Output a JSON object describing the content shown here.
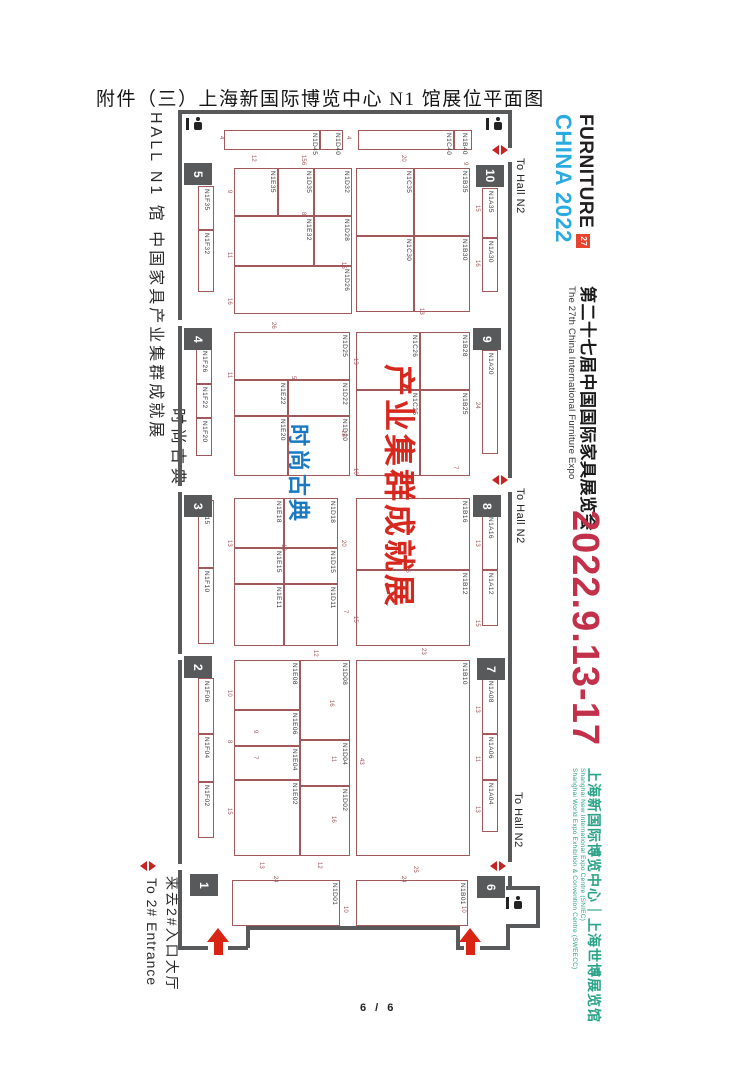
{
  "page": {
    "title": "附件（三）上海新国际博览中心 N1 馆展位平面图",
    "footer": "6 / 6"
  },
  "left_sidebar": {
    "hall_line": "HALL N1 馆  中国家具产业集群成就展",
    "hall_line2": "时尚古典",
    "entrance_en": "To 2# Entrance",
    "entrance_cn": "来去2#入口大厅"
  },
  "right_sidebar": {
    "logo": {
      "line1": "FURNITURE",
      "line2": "CHINA 2022",
      "badge": "27"
    },
    "expo_title_cn": "第二十七届中国国际家具展览会",
    "expo_title_en": "The 27th China International Furniture Expo",
    "dates": "2022.9.13-17",
    "venue_cn": "上海新国际博览中心｜上海世博展览馆",
    "venue_en1": "Shanghai New International Expo Centre (SNIEC)",
    "venue_en2": "Shanghai World Expo Exhibition & Convention Centre (SWEECC)",
    "colors": {
      "dates": "#c2304a",
      "venue": "#2aa389",
      "logo_blue": "#29abe2",
      "badge_bg": "#e8432f"
    }
  },
  "floorplan": {
    "overlay_red": "产业集群成就展",
    "overlay_blue": "时尚古典",
    "to_hall": {
      "label": "To Hall N2",
      "positions": [
        {
          "x": 514,
          "y": 158
        },
        {
          "x": 514,
          "y": 488
        },
        {
          "x": 512,
          "y": 792
        }
      ]
    },
    "gates": [
      {
        "n": "5",
        "x": 184,
        "y": 163
      },
      {
        "n": "4",
        "x": 184,
        "y": 328
      },
      {
        "n": "3",
        "x": 184,
        "y": 495
      },
      {
        "n": "2",
        "x": 184,
        "y": 656
      },
      {
        "n": "1",
        "x": 190,
        "y": 874
      },
      {
        "n": "10",
        "x": 476,
        "y": 165
      },
      {
        "n": "9",
        "x": 473,
        "y": 328
      },
      {
        "n": "8",
        "x": 473,
        "y": 495
      },
      {
        "n": "7",
        "x": 477,
        "y": 658
      },
      {
        "n": "6",
        "x": 477,
        "y": 876
      }
    ],
    "icons": {
      "gate_markers": [
        {
          "x": 492,
          "y": 145
        },
        {
          "x": 492,
          "y": 475
        },
        {
          "x": 490,
          "y": 861
        },
        {
          "x": 140,
          "y": 861
        }
      ],
      "entrance_arrows": [
        {
          "x": 206,
          "y": 928
        },
        {
          "x": 458,
          "y": 928
        }
      ],
      "restrooms": [
        {
          "x": 186,
          "y": 117
        },
        {
          "x": 486,
          "y": 117
        },
        {
          "x": 506,
          "y": 896
        }
      ]
    },
    "booths": [
      {
        "id": "N1D45",
        "x": 224,
        "y": 130,
        "w": 96,
        "h": 20
      },
      {
        "id": "N1D40",
        "x": 320,
        "y": 130,
        "w": 23,
        "h": 20
      },
      {
        "id": "N1C40",
        "x": 358,
        "y": 130,
        "w": 96,
        "h": 20
      },
      {
        "id": "N1B40",
        "x": 454,
        "y": 130,
        "w": 18,
        "h": 20
      },
      {
        "id": "N1F35",
        "x": 198,
        "y": 186,
        "w": 16,
        "h": 44
      },
      {
        "id": "N1F32",
        "x": 198,
        "y": 230,
        "w": 16,
        "h": 62
      },
      {
        "id": "N1E35",
        "x": 234,
        "y": 168,
        "w": 44,
        "h": 48
      },
      {
        "id": "N1D35",
        "x": 278,
        "y": 168,
        "w": 36,
        "h": 48
      },
      {
        "id": "N1D32",
        "x": 314,
        "y": 168,
        "w": 38,
        "h": 48
      },
      {
        "id": "N1E32",
        "x": 234,
        "y": 216,
        "w": 80,
        "h": 50
      },
      {
        "id": "N1D28",
        "x": 314,
        "y": 216,
        "w": 38,
        "h": 50
      },
      {
        "id": "N1D26",
        "x": 234,
        "y": 266,
        "w": 118,
        "h": 48
      },
      {
        "id": "N1C35",
        "x": 356,
        "y": 168,
        "w": 58,
        "h": 68
      },
      {
        "id": "N1C30",
        "x": 356,
        "y": 236,
        "w": 58,
        "h": 76
      },
      {
        "id": "N1B35",
        "x": 414,
        "y": 168,
        "w": 56,
        "h": 68
      },
      {
        "id": "N1B30",
        "x": 414,
        "y": 236,
        "w": 56,
        "h": 76
      },
      {
        "id": "N1A35",
        "x": 482,
        "y": 188,
        "w": 16,
        "h": 50
      },
      {
        "id": "N1A30",
        "x": 482,
        "y": 238,
        "w": 16,
        "h": 54
      },
      {
        "id": "N1F26",
        "x": 196,
        "y": 348,
        "w": 16,
        "h": 36
      },
      {
        "id": "N1F22",
        "x": 196,
        "y": 384,
        "w": 16,
        "h": 34
      },
      {
        "id": "N1F20",
        "x": 196,
        "y": 418,
        "w": 16,
        "h": 38
      },
      {
        "id": "N1D25",
        "x": 234,
        "y": 332,
        "w": 116,
        "h": 48
      },
      {
        "id": "N1E22",
        "x": 234,
        "y": 380,
        "w": 54,
        "h": 36
      },
      {
        "id": "N1D22",
        "x": 288,
        "y": 380,
        "w": 62,
        "h": 36
      },
      {
        "id": "N1E20",
        "x": 234,
        "y": 416,
        "w": 54,
        "h": 60
      },
      {
        "id": "N1D20",
        "x": 288,
        "y": 416,
        "w": 62,
        "h": 60
      },
      {
        "id": "N1C26",
        "x": 356,
        "y": 332,
        "w": 64,
        "h": 58
      },
      {
        "id": "N1C25",
        "x": 356,
        "y": 390,
        "w": 64,
        "h": 86
      },
      {
        "id": "N1B28",
        "x": 420,
        "y": 332,
        "w": 50,
        "h": 58
      },
      {
        "id": "N1B25",
        "x": 420,
        "y": 390,
        "w": 50,
        "h": 86
      },
      {
        "id": "N1A20",
        "x": 482,
        "y": 350,
        "w": 16,
        "h": 104
      },
      {
        "id": "N1F15",
        "x": 198,
        "y": 500,
        "w": 16,
        "h": 68
      },
      {
        "id": "N1F10",
        "x": 198,
        "y": 568,
        "w": 16,
        "h": 76
      },
      {
        "id": "N1E18",
        "x": 234,
        "y": 498,
        "w": 50,
        "h": 50
      },
      {
        "id": "N1D18",
        "x": 284,
        "y": 498,
        "w": 54,
        "h": 50
      },
      {
        "id": "N1E15",
        "x": 234,
        "y": 548,
        "w": 50,
        "h": 36
      },
      {
        "id": "N1D15",
        "x": 284,
        "y": 548,
        "w": 54,
        "h": 36
      },
      {
        "id": "N1E11",
        "x": 234,
        "y": 584,
        "w": 50,
        "h": 62
      },
      {
        "id": "N1D11",
        "x": 284,
        "y": 584,
        "w": 54,
        "h": 62
      },
      {
        "id": "N1B16",
        "x": 356,
        "y": 498,
        "w": 114,
        "h": 72
      },
      {
        "id": "N1B12",
        "x": 356,
        "y": 570,
        "w": 114,
        "h": 76
      },
      {
        "id": "N1A16",
        "x": 482,
        "y": 514,
        "w": 16,
        "h": 56
      },
      {
        "id": "N1A12",
        "x": 482,
        "y": 570,
        "w": 16,
        "h": 56
      },
      {
        "id": "N1F06",
        "x": 198,
        "y": 678,
        "w": 16,
        "h": 56
      },
      {
        "id": "N1F04",
        "x": 198,
        "y": 734,
        "w": 16,
        "h": 48
      },
      {
        "id": "N1F02",
        "x": 198,
        "y": 782,
        "w": 16,
        "h": 56
      },
      {
        "id": "N1E08",
        "x": 234,
        "y": 660,
        "w": 66,
        "h": 50
      },
      {
        "id": "N1E06",
        "x": 234,
        "y": 710,
        "w": 66,
        "h": 36
      },
      {
        "id": "N1E04",
        "x": 234,
        "y": 746,
        "w": 66,
        "h": 34
      },
      {
        "id": "N1E02",
        "x": 234,
        "y": 780,
        "w": 66,
        "h": 76
      },
      {
        "id": "N1D08",
        "x": 300,
        "y": 660,
        "w": 50,
        "h": 80
      },
      {
        "id": "N1D04",
        "x": 300,
        "y": 740,
        "w": 50,
        "h": 46
      },
      {
        "id": "N1D02",
        "x": 300,
        "y": 786,
        "w": 50,
        "h": 70
      },
      {
        "id": "N1B10",
        "x": 356,
        "y": 660,
        "w": 114,
        "h": 196
      },
      {
        "id": "N1A08",
        "x": 482,
        "y": 678,
        "w": 16,
        "h": 56
      },
      {
        "id": "N1A06",
        "x": 482,
        "y": 734,
        "w": 16,
        "h": 46
      },
      {
        "id": "N1A04",
        "x": 482,
        "y": 780,
        "w": 16,
        "h": 52
      },
      {
        "id": "N1D01",
        "x": 232,
        "y": 880,
        "w": 108,
        "h": 46
      },
      {
        "id": "N1B01",
        "x": 356,
        "y": 880,
        "w": 112,
        "h": 46
      }
    ],
    "dims": [
      {
        "t": "4",
        "x": 218,
        "y": 136
      },
      {
        "t": "12",
        "x": 250,
        "y": 155
      },
      {
        "t": "15",
        "x": 300,
        "y": 155
      },
      {
        "t": "20",
        "x": 400,
        "y": 155
      },
      {
        "t": "4",
        "x": 345,
        "y": 136
      },
      {
        "t": "9",
        "x": 226,
        "y": 190
      },
      {
        "t": "6",
        "x": 300,
        "y": 162
      },
      {
        "t": "8",
        "x": 300,
        "y": 212
      },
      {
        "t": "11",
        "x": 226,
        "y": 252
      },
      {
        "t": "16",
        "x": 226,
        "y": 298
      },
      {
        "t": "15",
        "x": 340,
        "y": 262
      },
      {
        "t": "13",
        "x": 418,
        "y": 308
      },
      {
        "t": "9",
        "x": 462,
        "y": 162
      },
      {
        "t": "15",
        "x": 474,
        "y": 205
      },
      {
        "t": "16",
        "x": 474,
        "y": 260
      },
      {
        "t": "26",
        "x": 270,
        "y": 322
      },
      {
        "t": "13",
        "x": 352,
        "y": 358
      },
      {
        "t": "11",
        "x": 226,
        "y": 372
      },
      {
        "t": "5",
        "x": 290,
        "y": 376
      },
      {
        "t": "15",
        "x": 340,
        "y": 430
      },
      {
        "t": "10",
        "x": 352,
        "y": 468
      },
      {
        "t": "18",
        "x": 404,
        "y": 478
      },
      {
        "t": "7",
        "x": 452,
        "y": 466
      },
      {
        "t": "24",
        "x": 474,
        "y": 402
      },
      {
        "t": "13",
        "x": 226,
        "y": 540
      },
      {
        "t": "13",
        "x": 280,
        "y": 544
      },
      {
        "t": "20",
        "x": 340,
        "y": 540
      },
      {
        "t": "16",
        "x": 404,
        "y": 566
      },
      {
        "t": "7",
        "x": 342,
        "y": 610
      },
      {
        "t": "15",
        "x": 352,
        "y": 616
      },
      {
        "t": "13",
        "x": 474,
        "y": 540
      },
      {
        "t": "15",
        "x": 474,
        "y": 620
      },
      {
        "t": "23",
        "x": 420,
        "y": 648
      },
      {
        "t": "12",
        "x": 312,
        "y": 650
      },
      {
        "t": "10",
        "x": 226,
        "y": 690
      },
      {
        "t": "8",
        "x": 226,
        "y": 740
      },
      {
        "t": "9",
        "x": 252,
        "y": 730
      },
      {
        "t": "7",
        "x": 252,
        "y": 756
      },
      {
        "t": "15",
        "x": 226,
        "y": 808
      },
      {
        "t": "16",
        "x": 328,
        "y": 700
      },
      {
        "t": "11",
        "x": 330,
        "y": 756
      },
      {
        "t": "16",
        "x": 330,
        "y": 816
      },
      {
        "t": "43",
        "x": 358,
        "y": 758
      },
      {
        "t": "13",
        "x": 474,
        "y": 706
      },
      {
        "t": "11",
        "x": 474,
        "y": 756
      },
      {
        "t": "13",
        "x": 474,
        "y": 806
      },
      {
        "t": "13",
        "x": 258,
        "y": 862
      },
      {
        "t": "12",
        "x": 316,
        "y": 862
      },
      {
        "t": "24",
        "x": 272,
        "y": 876
      },
      {
        "t": "10",
        "x": 342,
        "y": 906
      },
      {
        "t": "25",
        "x": 412,
        "y": 866
      },
      {
        "t": "24",
        "x": 400,
        "y": 876
      },
      {
        "t": "10",
        "x": 460,
        "y": 906
      }
    ]
  }
}
